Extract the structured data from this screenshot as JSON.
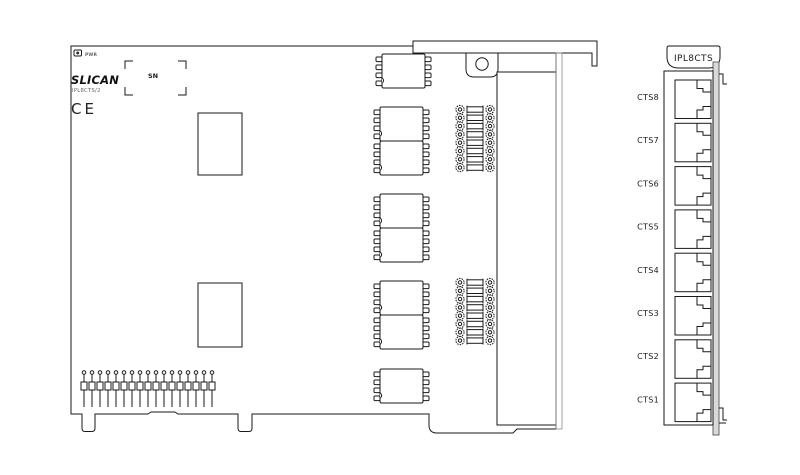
{
  "board": {
    "pwr_label": "PWR",
    "brand": "SLICAN",
    "model": "IPL8CTS/2",
    "ce_mark": "CE",
    "sn_label": "SN"
  },
  "panel": {
    "tab_label": "IPL8CTS",
    "ports": [
      {
        "label": "CTS8"
      },
      {
        "label": "CTS7"
      },
      {
        "label": "CTS6"
      },
      {
        "label": "CTS5"
      },
      {
        "label": "CTS4"
      },
      {
        "label": "CTS3"
      },
      {
        "label": "CTS2"
      },
      {
        "label": "CTS1"
      }
    ]
  },
  "colors": {
    "line": "#1a1a1a",
    "line_soft": "#8a8a8a",
    "panel_strip": "#d9d9d9",
    "background": "#ffffff"
  }
}
